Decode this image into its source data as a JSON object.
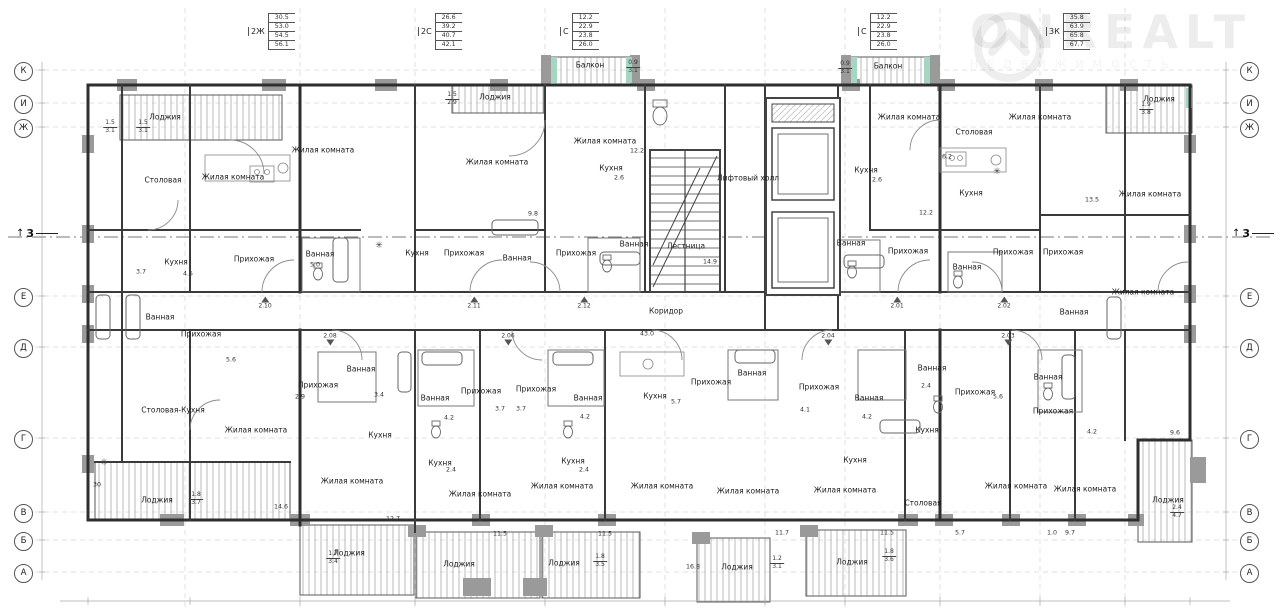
{
  "watermark": {
    "brand": "ONREALT",
    "subtitle": "НЕДВИЖИМОСТЬ"
  },
  "area_tables": [
    {
      "label": "2Ж",
      "x": 248,
      "y": 13,
      "values": [
        "30.5",
        "53.0",
        "54.5",
        "56.1"
      ]
    },
    {
      "label": "2С",
      "x": 418,
      "y": 13,
      "values": [
        "26.6",
        "39.2",
        "40.7",
        "42.1"
      ]
    },
    {
      "label": "С",
      "x": 560,
      "y": 13,
      "values": [
        "12.2",
        "22.9",
        "23.8",
        "26.0"
      ]
    },
    {
      "label": "С",
      "x": 858,
      "y": 13,
      "values": [
        "12.2",
        "22.9",
        "23.8",
        "26.0"
      ]
    },
    {
      "label": "3К",
      "x": 1046,
      "y": 13,
      "values": [
        "35.8",
        "63.9",
        "65.8",
        "67.7"
      ]
    }
  ],
  "axes": {
    "labels": [
      "К",
      "И",
      "Ж",
      "Е",
      "Д",
      "Г",
      "В",
      "Б",
      "А"
    ],
    "ys": [
      70,
      103,
      127,
      296,
      347,
      438,
      512,
      540,
      572
    ],
    "left_x": 14,
    "right_x": 1240
  },
  "section_markers": [
    {
      "label": "3",
      "x": 16,
      "y": 228
    },
    {
      "label": "3",
      "x": 1232,
      "y": 228
    }
  ],
  "room_labels": [
    {
      "t": "Лоджия",
      "x": 165,
      "y": 117
    },
    {
      "t": "Столовая",
      "x": 163,
      "y": 180
    },
    {
      "t": "Жилая комната",
      "x": 233,
      "y": 177
    },
    {
      "t": "Жилая комната",
      "x": 323,
      "y": 150
    },
    {
      "t": "Лоджия",
      "x": 495,
      "y": 97
    },
    {
      "t": "Жилая комната",
      "x": 497,
      "y": 162
    },
    {
      "t": "Жилая комната",
      "x": 605,
      "y": 141
    },
    {
      "t": "Кухня",
      "x": 611,
      "y": 168
    },
    {
      "t": "Балкон",
      "x": 590,
      "y": 65
    },
    {
      "t": "Балкон",
      "x": 888,
      "y": 66
    },
    {
      "t": "Лифтовый холл",
      "x": 748,
      "y": 178
    },
    {
      "t": "Лестница",
      "x": 686,
      "y": 246
    },
    {
      "t": "Коридор",
      "x": 666,
      "y": 311
    },
    {
      "t": "Кухня",
      "x": 176,
      "y": 262
    },
    {
      "t": "Прихожая",
      "x": 254,
      "y": 259
    },
    {
      "t": "Ванная",
      "x": 320,
      "y": 254
    },
    {
      "t": "Ванная",
      "x": 160,
      "y": 317
    },
    {
      "t": "Прихожая",
      "x": 201,
      "y": 334
    },
    {
      "t": "Кухня",
      "x": 417,
      "y": 253
    },
    {
      "t": "Прихожая",
      "x": 464,
      "y": 253
    },
    {
      "t": "Ванная",
      "x": 517,
      "y": 258
    },
    {
      "t": "Прихожая",
      "x": 576,
      "y": 253
    },
    {
      "t": "Ванная",
      "x": 634,
      "y": 244
    },
    {
      "t": "Кухня",
      "x": 866,
      "y": 170
    },
    {
      "t": "Жилая комната",
      "x": 909,
      "y": 117
    },
    {
      "t": "Столовая",
      "x": 974,
      "y": 132
    },
    {
      "t": "Жилая комната",
      "x": 1040,
      "y": 117
    },
    {
      "t": "Кухня",
      "x": 971,
      "y": 193
    },
    {
      "t": "Ванная",
      "x": 851,
      "y": 243
    },
    {
      "t": "Прихожая",
      "x": 908,
      "y": 251
    },
    {
      "t": "Ванная",
      "x": 967,
      "y": 267
    },
    {
      "t": "Прихожая",
      "x": 1013,
      "y": 252
    },
    {
      "t": "Прихожая",
      "x": 1063,
      "y": 252
    },
    {
      "t": "Ванная",
      "x": 1074,
      "y": 312
    },
    {
      "t": "Жилая комната",
      "x": 1150,
      "y": 194
    },
    {
      "t": "Жилая комната",
      "x": 1143,
      "y": 292
    },
    {
      "t": "Лоджия",
      "x": 1159,
      "y": 99
    },
    {
      "t": "Столовая-Кухня",
      "x": 173,
      "y": 410
    },
    {
      "t": "Лоджия",
      "x": 157,
      "y": 500
    },
    {
      "t": "Жилая комната",
      "x": 256,
      "y": 430
    },
    {
      "t": "Прихожая",
      "x": 318,
      "y": 385
    },
    {
      "t": "Ванная",
      "x": 361,
      "y": 369
    },
    {
      "t": "Кухня",
      "x": 380,
      "y": 435
    },
    {
      "t": "Жилая комната",
      "x": 352,
      "y": 481
    },
    {
      "t": "Лоджия",
      "x": 349,
      "y": 553
    },
    {
      "t": "Ванная",
      "x": 435,
      "y": 398
    },
    {
      "t": "Прихожая",
      "x": 481,
      "y": 391
    },
    {
      "t": "Прихожая",
      "x": 536,
      "y": 389
    },
    {
      "t": "Ванная",
      "x": 588,
      "y": 398
    },
    {
      "t": "Кухня",
      "x": 440,
      "y": 463
    },
    {
      "t": "Кухня",
      "x": 573,
      "y": 461
    },
    {
      "t": "Жилая комната",
      "x": 480,
      "y": 494
    },
    {
      "t": "Жилая комната",
      "x": 562,
      "y": 486
    },
    {
      "t": "Лоджия",
      "x": 459,
      "y": 564
    },
    {
      "t": "Лоджия",
      "x": 564,
      "y": 563
    },
    {
      "t": "Кухня",
      "x": 655,
      "y": 396
    },
    {
      "t": "Прихожая",
      "x": 711,
      "y": 382
    },
    {
      "t": "Ванная",
      "x": 752,
      "y": 373
    },
    {
      "t": "Жилая комната",
      "x": 662,
      "y": 486
    },
    {
      "t": "Жилая комната",
      "x": 748,
      "y": 491
    },
    {
      "t": "Лоджия",
      "x": 737,
      "y": 567
    },
    {
      "t": "Прихожая",
      "x": 819,
      "y": 387
    },
    {
      "t": "Ванная",
      "x": 869,
      "y": 398
    },
    {
      "t": "Кухня",
      "x": 855,
      "y": 460
    },
    {
      "t": "Жилая комната",
      "x": 845,
      "y": 490
    },
    {
      "t": "Лоджия",
      "x": 852,
      "y": 562
    },
    {
      "t": "Ванная",
      "x": 932,
      "y": 368
    },
    {
      "t": "Прихожая",
      "x": 975,
      "y": 392
    },
    {
      "t": "Кухня",
      "x": 927,
      "y": 430
    },
    {
      "t": "Столовая",
      "x": 923,
      "y": 503
    },
    {
      "t": "Жилая комната",
      "x": 1016,
      "y": 486
    },
    {
      "t": "Ванная",
      "x": 1048,
      "y": 377
    },
    {
      "t": "Прихожая",
      "x": 1053,
      "y": 411
    },
    {
      "t": "Жилая комната",
      "x": 1085,
      "y": 489
    },
    {
      "t": "Лоджия",
      "x": 1168,
      "y": 500
    }
  ],
  "dim_labels": [
    {
      "t": "5.0",
      "x": 315,
      "y": 265
    },
    {
      "t": "4.5",
      "x": 188,
      "y": 274
    },
    {
      "t": "3.7",
      "x": 141,
      "y": 272
    },
    {
      "t": "9.8",
      "x": 533,
      "y": 214
    },
    {
      "t": "12.2",
      "x": 637,
      "y": 151
    },
    {
      "t": "2.6",
      "x": 619,
      "y": 178
    },
    {
      "t": "14.9",
      "x": 710,
      "y": 262
    },
    {
      "t": "43.0",
      "x": 647,
      "y": 334
    },
    {
      "t": "12.2",
      "x": 926,
      "y": 213
    },
    {
      "t": "2.6",
      "x": 877,
      "y": 180
    },
    {
      "t": "6.2",
      "x": 947,
      "y": 157
    },
    {
      "t": "13.5",
      "x": 1092,
      "y": 200
    },
    {
      "t": "9.6",
      "x": 1175,
      "y": 433
    },
    {
      "t": "5.6",
      "x": 231,
      "y": 360
    },
    {
      "t": "2.9",
      "x": 300,
      "y": 397
    },
    {
      "t": "3.4",
      "x": 379,
      "y": 395
    },
    {
      "t": "14.6",
      "x": 281,
      "y": 507
    },
    {
      "t": "12.7",
      "x": 393,
      "y": 519
    },
    {
      "t": "11.5",
      "x": 500,
      "y": 534
    },
    {
      "t": "11.5",
      "x": 605,
      "y": 534
    },
    {
      "t": "16.8",
      "x": 693,
      "y": 567
    },
    {
      "t": "11.7",
      "x": 782,
      "y": 533
    },
    {
      "t": "11.5",
      "x": 887,
      "y": 533
    },
    {
      "t": "5.7",
      "x": 960,
      "y": 533
    },
    {
      "t": "1.0",
      "x": 1052,
      "y": 533
    },
    {
      "t": "9.7",
      "x": 1070,
      "y": 533
    },
    {
      "t": "3.7",
      "x": 500,
      "y": 409
    },
    {
      "t": "3.7",
      "x": 521,
      "y": 409
    },
    {
      "t": "4.2",
      "x": 449,
      "y": 418
    },
    {
      "t": "4.2",
      "x": 585,
      "y": 417
    },
    {
      "t": "2.4",
      "x": 451,
      "y": 470
    },
    {
      "t": "2.4",
      "x": 584,
      "y": 470
    },
    {
      "t": "5.7",
      "x": 676,
      "y": 402
    },
    {
      "t": "4.1",
      "x": 805,
      "y": 410
    },
    {
      "t": "4.2",
      "x": 867,
      "y": 417
    },
    {
      "t": "2.4",
      "x": 926,
      "y": 386
    },
    {
      "t": "5.6",
      "x": 998,
      "y": 397
    },
    {
      "t": "4.2",
      "x": 1092,
      "y": 432
    },
    {
      "t": "30",
      "x": 97,
      "y": 485
    }
  ],
  "frac_labels": [
    {
      "a": "1.5",
      "b": "3.1",
      "x": 110,
      "y": 127
    },
    {
      "a": "1.5",
      "b": "3.1",
      "x": 143,
      "y": 127
    },
    {
      "a": "1.5",
      "b": "2.9",
      "x": 452,
      "y": 99
    },
    {
      "a": "0.9",
      "b": "3.1",
      "x": 633,
      "y": 67
    },
    {
      "a": "0.9",
      "b": "3.1",
      "x": 845,
      "y": 68
    },
    {
      "a": "1.9",
      "b": "3.8",
      "x": 1146,
      "y": 109
    },
    {
      "a": "1.8",
      "b": "3.7",
      "x": 196,
      "y": 499
    },
    {
      "a": "1.7",
      "b": "3.4",
      "x": 333,
      "y": 558
    },
    {
      "a": "1.8",
      "b": "3.5",
      "x": 600,
      "y": 561
    },
    {
      "a": "1.2",
      "b": "3.1",
      "x": 777,
      "y": 563
    },
    {
      "a": "1.8",
      "b": "3.6",
      "x": 889,
      "y": 556
    },
    {
      "a": "2.4",
      "b": "4.7",
      "x": 1177,
      "y": 512
    }
  ],
  "door_marks": [
    {
      "t": "2.10",
      "x": 265,
      "y": 303,
      "d": "up"
    },
    {
      "t": "2.11",
      "x": 474,
      "y": 303,
      "d": "up"
    },
    {
      "t": "2.12",
      "x": 584,
      "y": 303,
      "d": "up"
    },
    {
      "t": "2.01",
      "x": 897,
      "y": 303,
      "d": "up"
    },
    {
      "t": "2.02",
      "x": 1004,
      "y": 303,
      "d": "up"
    },
    {
      "t": "2.08",
      "x": 330,
      "y": 339,
      "d": "down"
    },
    {
      "t": "2.06",
      "x": 508,
      "y": 339,
      "d": "down"
    },
    {
      "t": "2.04",
      "x": 828,
      "y": 339,
      "d": "down"
    },
    {
      "t": "2.03",
      "x": 1008,
      "y": 339,
      "d": "down"
    }
  ],
  "symbols": [
    {
      "t": "✳",
      "x": 379,
      "y": 246
    },
    {
      "t": "✳",
      "x": 997,
      "y": 172
    },
    {
      "t": "✳",
      "x": 104,
      "y": 463
    }
  ]
}
